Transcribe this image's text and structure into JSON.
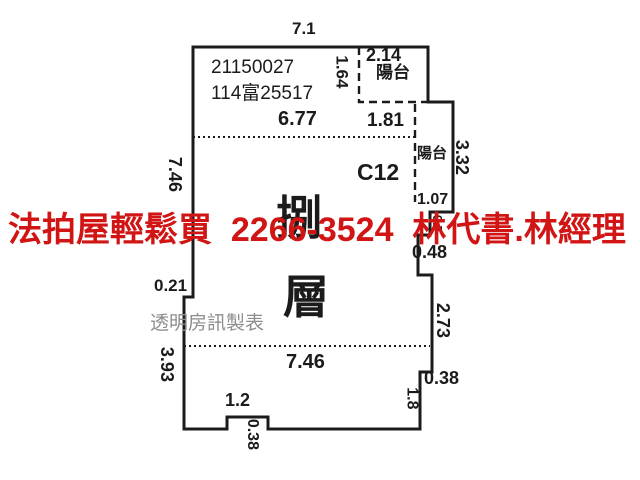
{
  "floorplan": {
    "case_number": "21150027",
    "case_reference": "114富25517",
    "unit_label": "C12",
    "floor_label_char1": "捌",
    "floor_label_char2": "層",
    "balcony_top_label": "陽台",
    "balcony_right_label": "陽台",
    "watermark": "透明房訊製表",
    "dims": {
      "top_width": "7.1",
      "balcony_top_width": "2.14",
      "balcony_top_depth": "1.64",
      "interior_top_width": "6.77",
      "balcony_top_inner_width": "1.81",
      "balcony_right_height": "3.32",
      "balcony_right_bottom_width": "1.07",
      "right_upper_step": "0.7",
      "right_step_width": "0.48",
      "left_height_upper": "7.46",
      "left_jog": "0.21",
      "left_height_lower": "3.93",
      "interior_bottom_width": "7.46",
      "right_height_lower": "2.73",
      "right_bottom_step": "0.38",
      "right_bottom_height": "1.8",
      "notch_width": "1.2",
      "notch_depth": "0.38"
    }
  },
  "overlay_ad": {
    "text": "法拍屋輕鬆買  2266-3524  林代書.林經理",
    "color": "#d11515"
  },
  "colors": {
    "line": "#1b1b1b",
    "watermark": "#8d8d8d",
    "background": "#ffffff"
  }
}
